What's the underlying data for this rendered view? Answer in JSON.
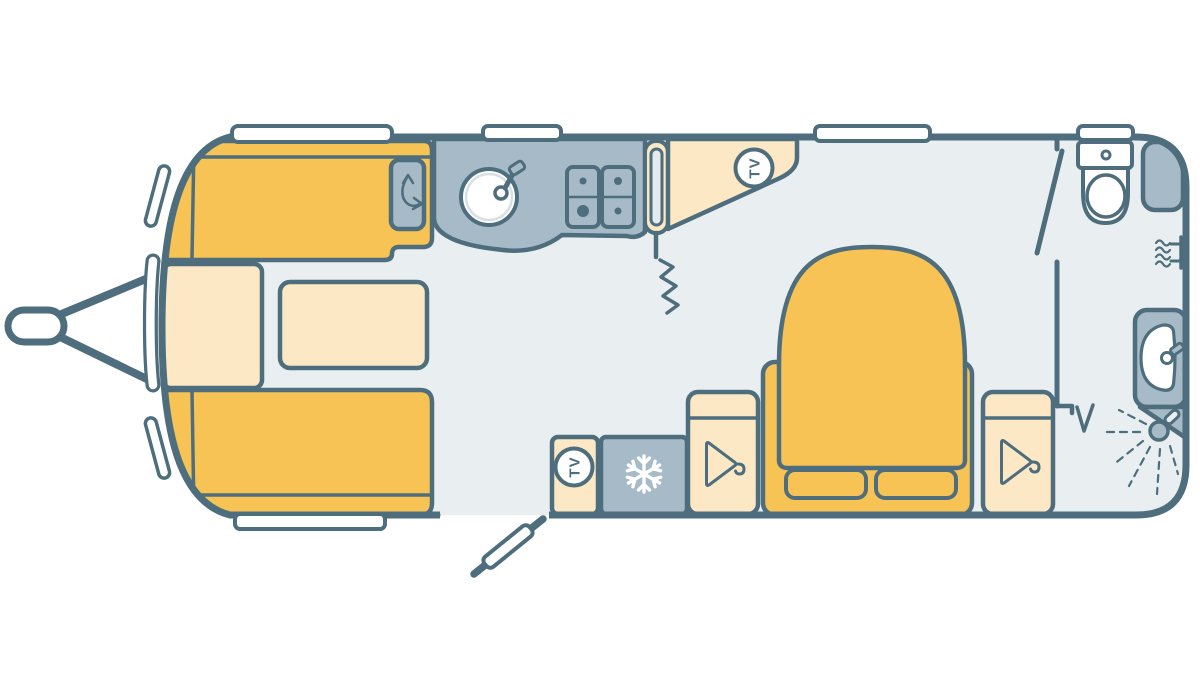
{
  "page": {
    "width": 1200,
    "height": 700,
    "background": "#ffffff"
  },
  "floorplan": {
    "type": "caravan-floorplan-top-view",
    "tv_label": "TV",
    "fixtures": [
      "tow-hitch",
      "front-lounge-bench-top",
      "front-lounge-bench-bottom",
      "front-chest-seat",
      "lounge-table",
      "swivel-storage-locker",
      "kitchen-counter",
      "sink-with-tap",
      "four-burner-hob",
      "interior-door",
      "curtain-divider",
      "corner-tv-shelf",
      "entrance-door-open",
      "island-bed",
      "pillows",
      "wardrobe-left",
      "wardrobe-right",
      "tv-cabinet",
      "fridge",
      "washroom-door-open",
      "toilet",
      "corner-cabinet",
      "heater",
      "washbasin",
      "shower-head"
    ],
    "icons": [
      {
        "name": "tv-point-icon",
        "glyph": "TV",
        "count": 2
      },
      {
        "name": "snowflake-icon",
        "meaning": "fridge"
      },
      {
        "name": "hanger-icon",
        "meaning": "wardrobe",
        "count": 2
      },
      {
        "name": "curved-arrow-icon",
        "meaning": "swivel-locker"
      },
      {
        "name": "heater-icon",
        "meaning": "blown-air-heater"
      },
      {
        "name": "shower-spray-icon",
        "meaning": "shower"
      }
    ],
    "window_count": 7
  },
  "colors": {
    "outline": "#4E6E7D",
    "yellow": "#F6C354",
    "cream": "#FCE8C4",
    "gray": "#A7BAC7",
    "floor": "#E9EEF1",
    "slot": "#E4EAED"
  }
}
